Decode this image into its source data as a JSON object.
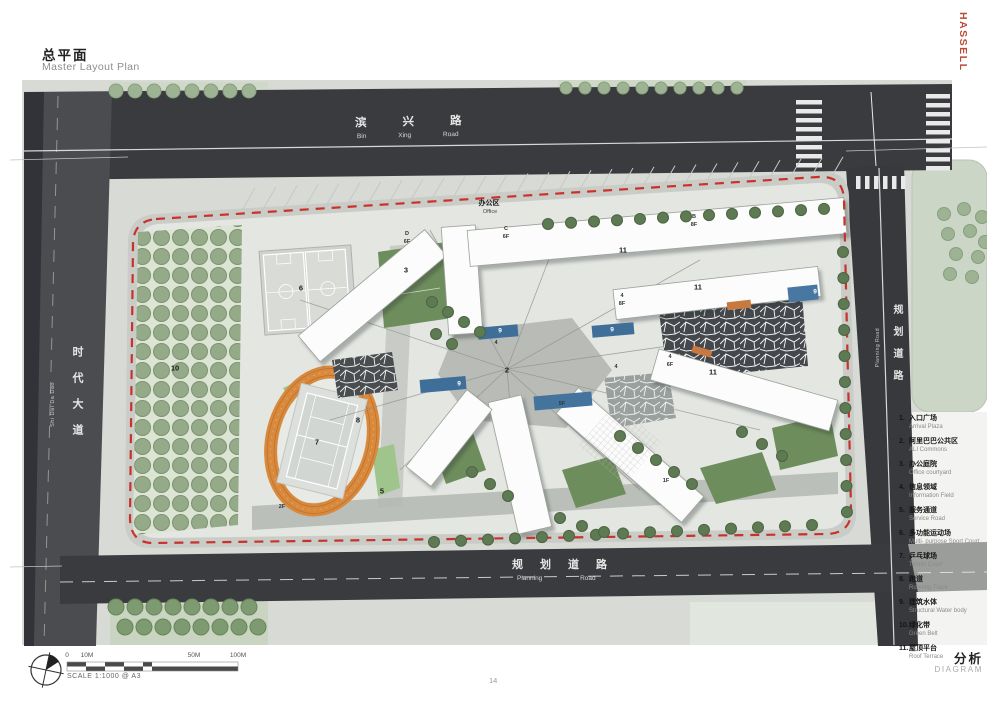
{
  "header": {
    "title_zh": "总平面",
    "title_en": "Master Layout Plan",
    "brand": "HASSELL"
  },
  "roads": {
    "top_zh": "滨兴路",
    "top_en": "Bin Xing Road",
    "left_zh": "时代大道",
    "left_en": "Shi Dai Da Dao",
    "right_zh": "规划道路",
    "right_en": "Planning Road",
    "bottom_zh": "规划道路",
    "bottom_en": "Planning Road"
  },
  "legend": {
    "items": [
      {
        "num": "1.",
        "zh": "入口广场",
        "en": "Arrival Plaza"
      },
      {
        "num": "2.",
        "zh": "阿里巴巴公共区",
        "en": "ALI Commons"
      },
      {
        "num": "3.",
        "zh": "办公庭院",
        "en": "Office courtyard"
      },
      {
        "num": "4.",
        "zh": "信息领域",
        "en": "Information Field"
      },
      {
        "num": "5.",
        "zh": "服务通道",
        "en": "Service Road"
      },
      {
        "num": "6.",
        "zh": "多功能运动场",
        "en": "Multi- purpose Sport Court"
      },
      {
        "num": "7.",
        "zh": "乒乓球场",
        "en": "Tennis Court"
      },
      {
        "num": "8.",
        "zh": "跑道",
        "en": "Running Track"
      },
      {
        "num": "9.",
        "zh": "建筑水体",
        "en": "Structural Water body"
      },
      {
        "num": "10.",
        "zh": "绿化带",
        "en": "Green Belt"
      },
      {
        "num": "11.",
        "zh": "屋顶平台",
        "en": "Roof Terrace"
      }
    ]
  },
  "map_labels": [
    {
      "t": "10",
      "x": 175,
      "y": 368
    },
    {
      "t": "6",
      "x": 301,
      "y": 288
    },
    {
      "t": "3",
      "x": 406,
      "y": 270
    },
    {
      "t": "7",
      "x": 317,
      "y": 442
    },
    {
      "t": "8",
      "x": 358,
      "y": 420
    },
    {
      "t": "2",
      "x": 507,
      "y": 370
    },
    {
      "t": "5",
      "x": 382,
      "y": 491
    },
    {
      "t": "2F",
      "x": 282,
      "y": 507,
      "cls": "sm"
    },
    {
      "t": "办公区",
      "x": 489,
      "y": 203,
      "cls": "zh"
    },
    {
      "t": "Office",
      "x": 490,
      "y": 212,
      "cls": "en"
    },
    {
      "t": "C",
      "x": 506,
      "y": 229,
      "cls": "sm"
    },
    {
      "t": "6F",
      "x": 506,
      "y": 237,
      "cls": "sm"
    },
    {
      "t": "D",
      "x": 407,
      "y": 234,
      "cls": "sm"
    },
    {
      "t": "6F",
      "x": 407,
      "y": 242,
      "cls": "sm"
    },
    {
      "t": "B",
      "x": 694,
      "y": 217,
      "cls": "sm"
    },
    {
      "t": "8F",
      "x": 694,
      "y": 225,
      "cls": "sm"
    },
    {
      "t": "11",
      "x": 623,
      "y": 250
    },
    {
      "t": "11",
      "x": 698,
      "y": 287
    },
    {
      "t": "11",
      "x": 713,
      "y": 372
    },
    {
      "t": "4",
      "x": 622,
      "y": 296,
      "cls": "sm"
    },
    {
      "t": "8F",
      "x": 622,
      "y": 304,
      "cls": "sm"
    },
    {
      "t": "4",
      "x": 496,
      "y": 343,
      "cls": "sm"
    },
    {
      "t": "4",
      "x": 616,
      "y": 367,
      "cls": "sm"
    },
    {
      "t": "4",
      "x": 670,
      "y": 357,
      "cls": "sm"
    },
    {
      "t": "6F",
      "x": 670,
      "y": 365,
      "cls": "sm"
    },
    {
      "t": "5F",
      "x": 562,
      "y": 404,
      "cls": "sm"
    },
    {
      "t": "1F",
      "x": 666,
      "y": 481,
      "cls": "sm"
    },
    {
      "t": "9",
      "x": 500,
      "y": 331,
      "cls": "wt"
    },
    {
      "t": "9",
      "x": 612,
      "y": 330,
      "cls": "wt"
    },
    {
      "t": "9",
      "x": 459,
      "y": 384,
      "cls": "wt"
    },
    {
      "t": "9",
      "x": 815,
      "y": 292,
      "cls": "wt"
    }
  ],
  "footer": {
    "scale_ticks": [
      "0",
      "10M",
      "50M",
      "100M"
    ],
    "scale_caption": "SCALE 1:1000 @ A3",
    "page_number": "14",
    "section_zh": "分析",
    "section_en": "DIAGRAM"
  },
  "colors": {
    "boundary_red": "#c8322b",
    "brand_red": "#bc4a34",
    "road_dark": "#3a3b3e",
    "water_blue": "#3f6e99",
    "track_orange": "#d8893c",
    "lawn_green": "#6e8d5c"
  }
}
